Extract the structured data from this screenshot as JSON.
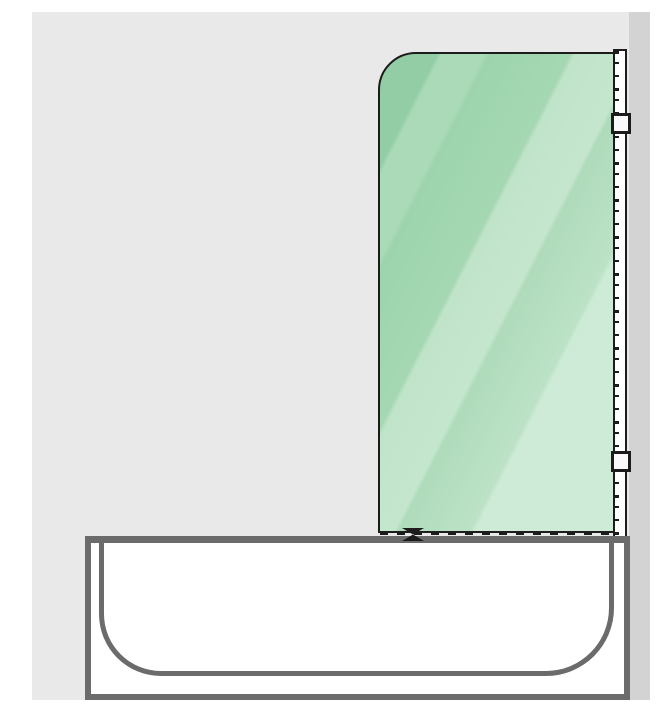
{
  "diagram": {
    "name": "bath-screen-side-view",
    "description": "Technical illustration of a hinged glass bath screen fixed to a wall profile above a bathtub, side view",
    "colors": {
      "page_bg": "#ffffff",
      "wall": "#e9e9e9",
      "side_wall": "#d3d3d3",
      "outline": "#1c1c1c",
      "glass_dark": "#92cda5",
      "glass_mid": "#aadab7",
      "glass_light": "#cdebd6",
      "tub_stroke": "#6b6b6b",
      "tub_fill": "#ffffff",
      "profile_fill": "#ffffff",
      "hinge_fill": "#fafafa"
    },
    "parts": [
      {
        "name": "wall-background"
      },
      {
        "name": "side-wall-strip"
      },
      {
        "name": "glass-panel"
      },
      {
        "name": "wall-mounting-profile"
      },
      {
        "name": "profile-hatch-ticks"
      },
      {
        "name": "hinge-bracket-top"
      },
      {
        "name": "hinge-bracket-bottom"
      },
      {
        "name": "glass-bottom-seal"
      },
      {
        "name": "water-deflector"
      },
      {
        "name": "bathtub-rim"
      },
      {
        "name": "bathtub-basin"
      }
    ]
  }
}
